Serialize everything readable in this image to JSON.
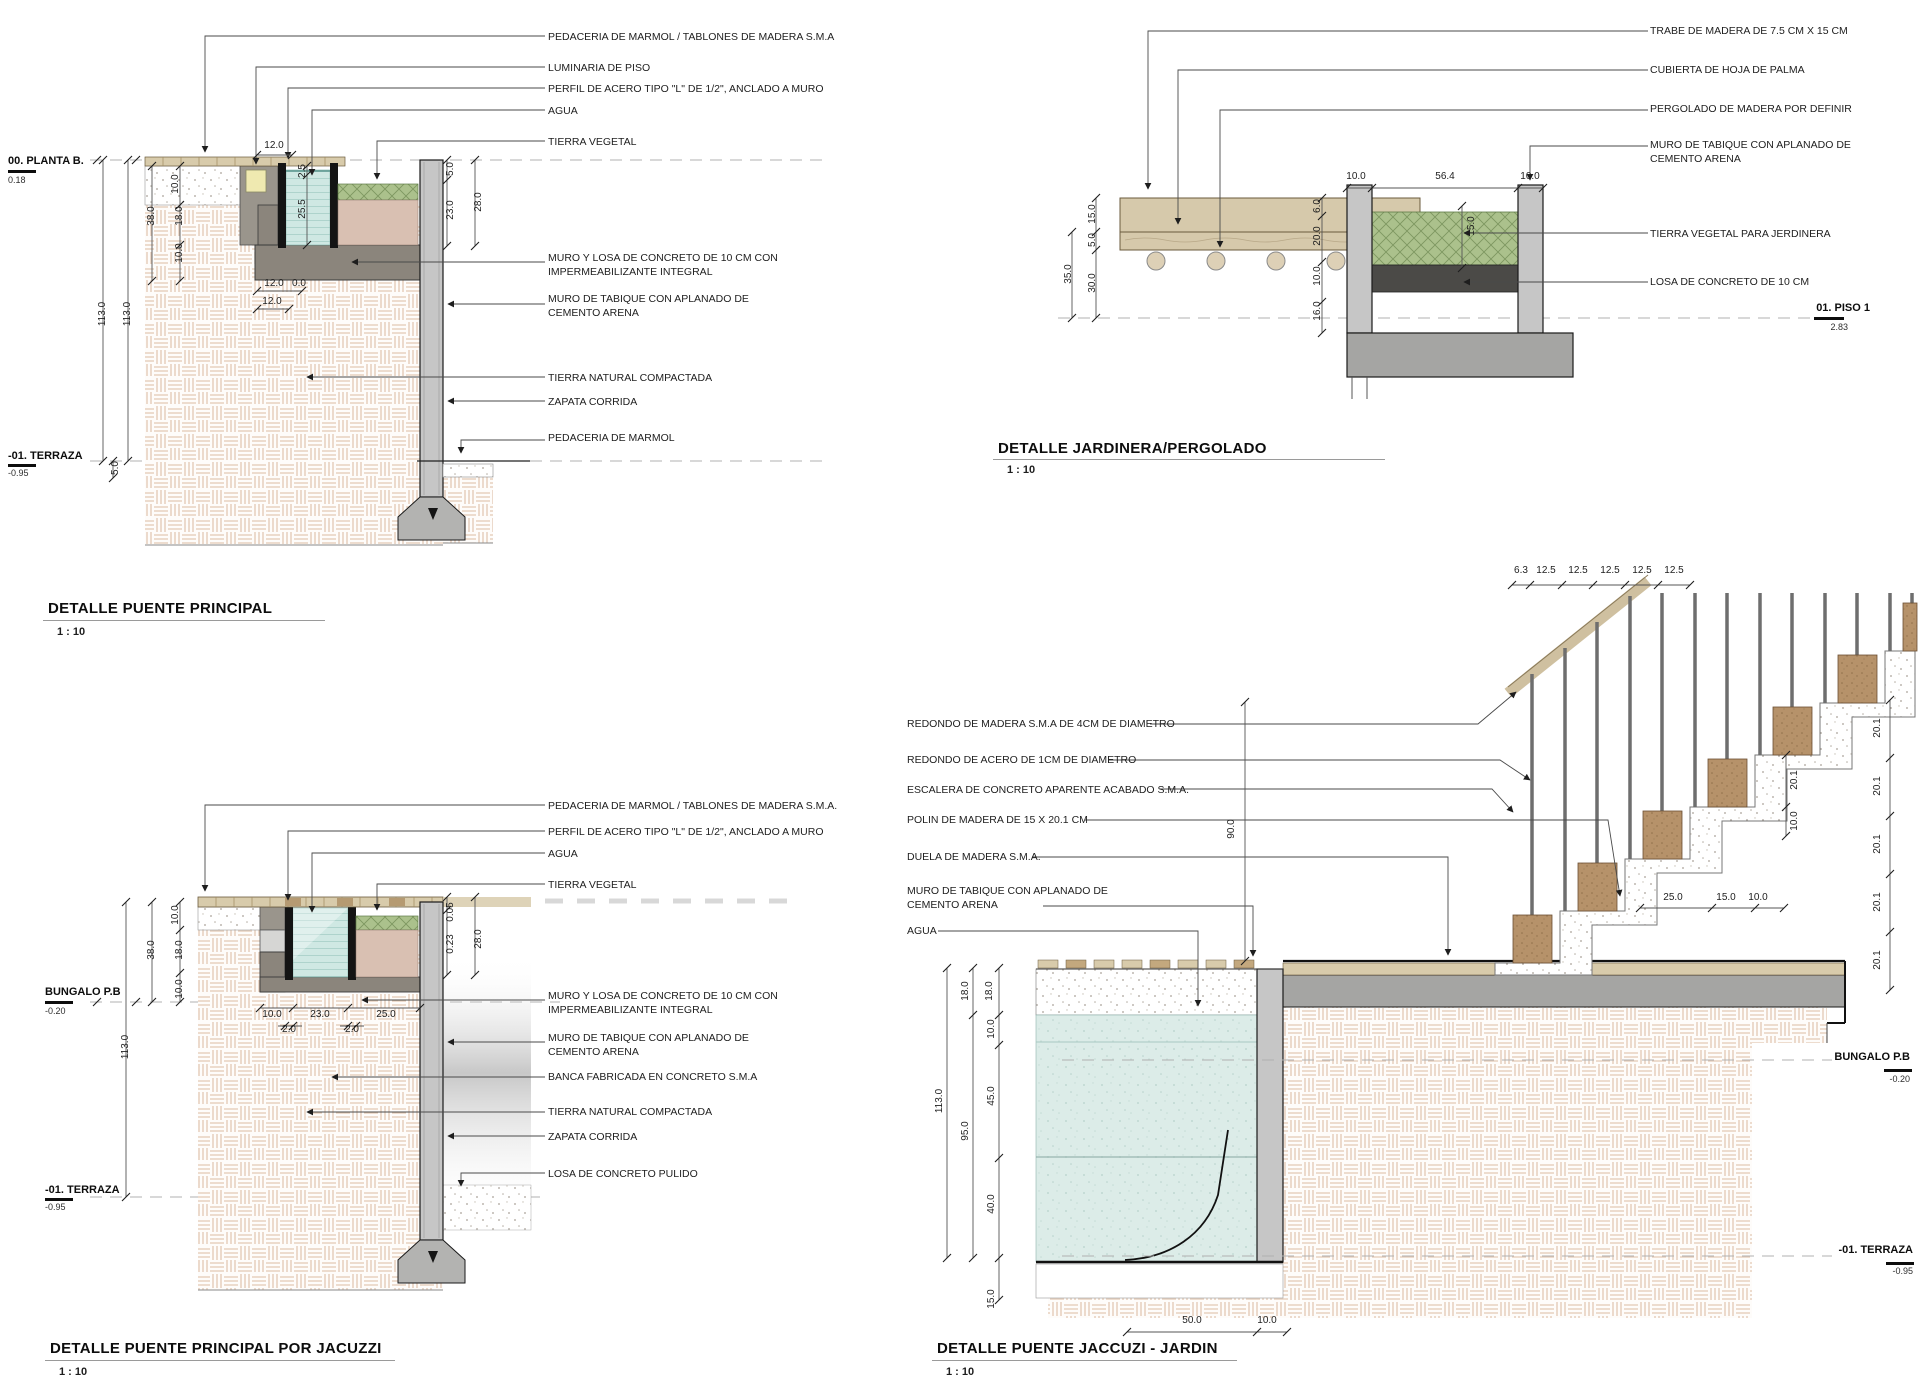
{
  "palette": {
    "hatch_line": "#e3c9b4",
    "water_channel": "#cfe8e3",
    "jacuzzi_water": "#dcece8",
    "soil_green": "#abc18c",
    "soil_pink": "#d9c0b2",
    "wood_tan": "#d8cbab",
    "wood_post": "#b6926a",
    "concrete_dark": "#8b857c",
    "wall_gray": "#c6c6c6",
    "slab_dark": "#4b4a47",
    "base_gray": "#a5a5a3"
  },
  "d1": {
    "title": "DETALLE PUENTE PRINCIPAL",
    "scale": "1 : 10",
    "level_top": {
      "name": "00. PLANTA B.",
      "value": "0.18"
    },
    "level_bottom": {
      "name": "-01. TERRAZA",
      "value": "-0.95"
    },
    "callouts": [
      "PEDACERIA DE MARMOL / TABLONES DE MADERA S.M.A",
      "LUMINARIA DE PISO",
      "PERFIL DE ACERO TIPO \"L\" DE 1/2\", ANCLADO A MURO",
      "AGUA",
      "TIERRA VEGETAL",
      "MURO Y LOSA DE CONCRETO DE 10 CM CON IMPERMEABILIZANTE INTEGRAL",
      "MURO DE TABIQUE  CON APLANADO DE CEMENTO ARENA",
      "TIERRA NATURAL COMPACTADA",
      "ZAPATA CORRIDA",
      "PEDACERIA DE MARMOL"
    ],
    "dims": [
      "12.0",
      "10.0",
      "38.0",
      "18.0",
      "10.0",
      "113.0",
      "113.0",
      "2.5",
      "25.5",
      "5.0",
      "23.0",
      "28.0",
      "12.0",
      "0.0",
      "12.0",
      "5.0"
    ]
  },
  "d2": {
    "title": "DETALLE JARDINERA/PERGOLADO",
    "scale": "1 : 10",
    "level_right": {
      "name": "01. PISO 1",
      "value": "2.83"
    },
    "callouts": [
      "TRABE DE MADERA DE 7.5 CM X 15 CM",
      "CUBIERTA DE HOJA DE PALMA",
      "PERGOLADO DE MADERA POR DEFINIR",
      "MURO DE TABIQUE  CON APLANADO DE CEMENTO ARENA",
      "TIERRA VEGETAL PARA JERDINERA",
      "LOSA DE CONCRETO DE 10 CM"
    ],
    "dims": [
      "10.0",
      "56.4",
      "10.0",
      "15.0",
      "5.0",
      "35.0",
      "30.0",
      "6.0",
      "20.0",
      "10.0",
      "16.0",
      "15.0"
    ]
  },
  "d3": {
    "title": "DETALLE PUENTE PRINCIPAL POR JACUZZI",
    "scale": "1 : 10",
    "level_top": {
      "name": "BUNGALO P.B",
      "value": "-0.20"
    },
    "level_bottom": {
      "name": "-01. TERRAZA",
      "value": "-0.95"
    },
    "callouts": [
      "PEDACERIA DE MARMOL / TABLONES DE MADERA S.M.A.",
      "PERFIL DE ACERO TIPO \"L\" DE 1/2\", ANCLADO A MURO",
      "AGUA",
      "TIERRA VEGETAL",
      "MURO Y LOSA DE CONCRETO DE 10 CM CON IMPERMEABILIZANTE INTEGRAL",
      "MURO DE TABIQUE  CON APLANADO DE CEMENTO ARENA",
      "BANCA FABRICADA EN CONCRETO S.M.A",
      "TIERRA NATURAL COMPACTADA",
      "ZAPATA CORRIDA",
      "LOSA DE CONCRETO PULIDO"
    ],
    "dims": [
      "10.0",
      "38.0",
      "18.0",
      "10.0",
      "113.0",
      "0.05",
      "0.23",
      "28.0",
      "10.0",
      "23.0",
      "25.0",
      "2.0",
      "2.0"
    ]
  },
  "d4": {
    "title": "DETALLE PUENTE JACCUZI - JARDIN",
    "scale": "1 : 10",
    "level_top": {
      "name": "BUNGALO P.B",
      "value": "-0.20"
    },
    "level_bottom": {
      "name": "-01. TERRAZA",
      "value": "-0.95"
    },
    "callouts": [
      "REDONDO DE MADERA S.M.A DE 4CM DE DIAMETRO",
      "REDONDO DE ACERO DE 1CM DE DIAMETRO",
      "ESCALERA DE CONCRETO APARENTE ACABADO S.M.A.",
      "POLIN DE MADERA DE 15 X 20.1 CM",
      "DUELA DE MADERA S.M.A.",
      "MURO DE TABIQUE  CON APLANADO DE CEMENTO ARENA",
      "AGUA"
    ],
    "dims": [
      "6.3",
      "12.5",
      "12.5",
      "12.5",
      "12.5",
      "12.5",
      "20.1",
      "20.1",
      "20.1",
      "20.1",
      "20.1",
      "20.1",
      "10.0",
      "25.0",
      "15.0",
      "10.0",
      "90.0",
      "113.0",
      "18.0",
      "95.0",
      "18.0",
      "10.0",
      "45.0",
      "40.0",
      "15.0",
      "50.0",
      "10.0"
    ]
  }
}
